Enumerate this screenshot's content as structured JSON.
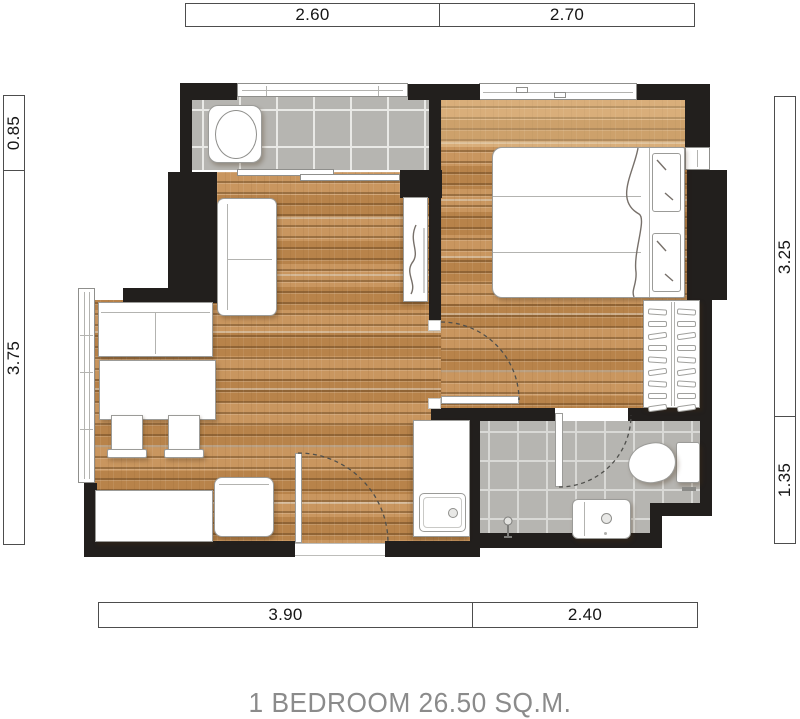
{
  "title": "1 BEDROOM 26.50 SQ.M.",
  "dimensions": {
    "top": [
      {
        "label": "2.60"
      },
      {
        "label": "2.70"
      }
    ],
    "bottom": [
      {
        "label": "3.90"
      },
      {
        "label": "2.40"
      }
    ],
    "left": [
      {
        "label": "0.85"
      },
      {
        "label": "3.75"
      }
    ],
    "right": [
      {
        "label": "3.25"
      },
      {
        "label": "1.35"
      }
    ]
  },
  "colors": {
    "wall": "#221f1d",
    "wood_base": "#c18d55",
    "wood_seam": "#8f6535",
    "tile_gray": "#b6b5b1",
    "grout": "#e9e9e6",
    "furniture_outline": "#9b9b98",
    "dimension_text": "#161616",
    "title_text": "#8b8b8b"
  }
}
